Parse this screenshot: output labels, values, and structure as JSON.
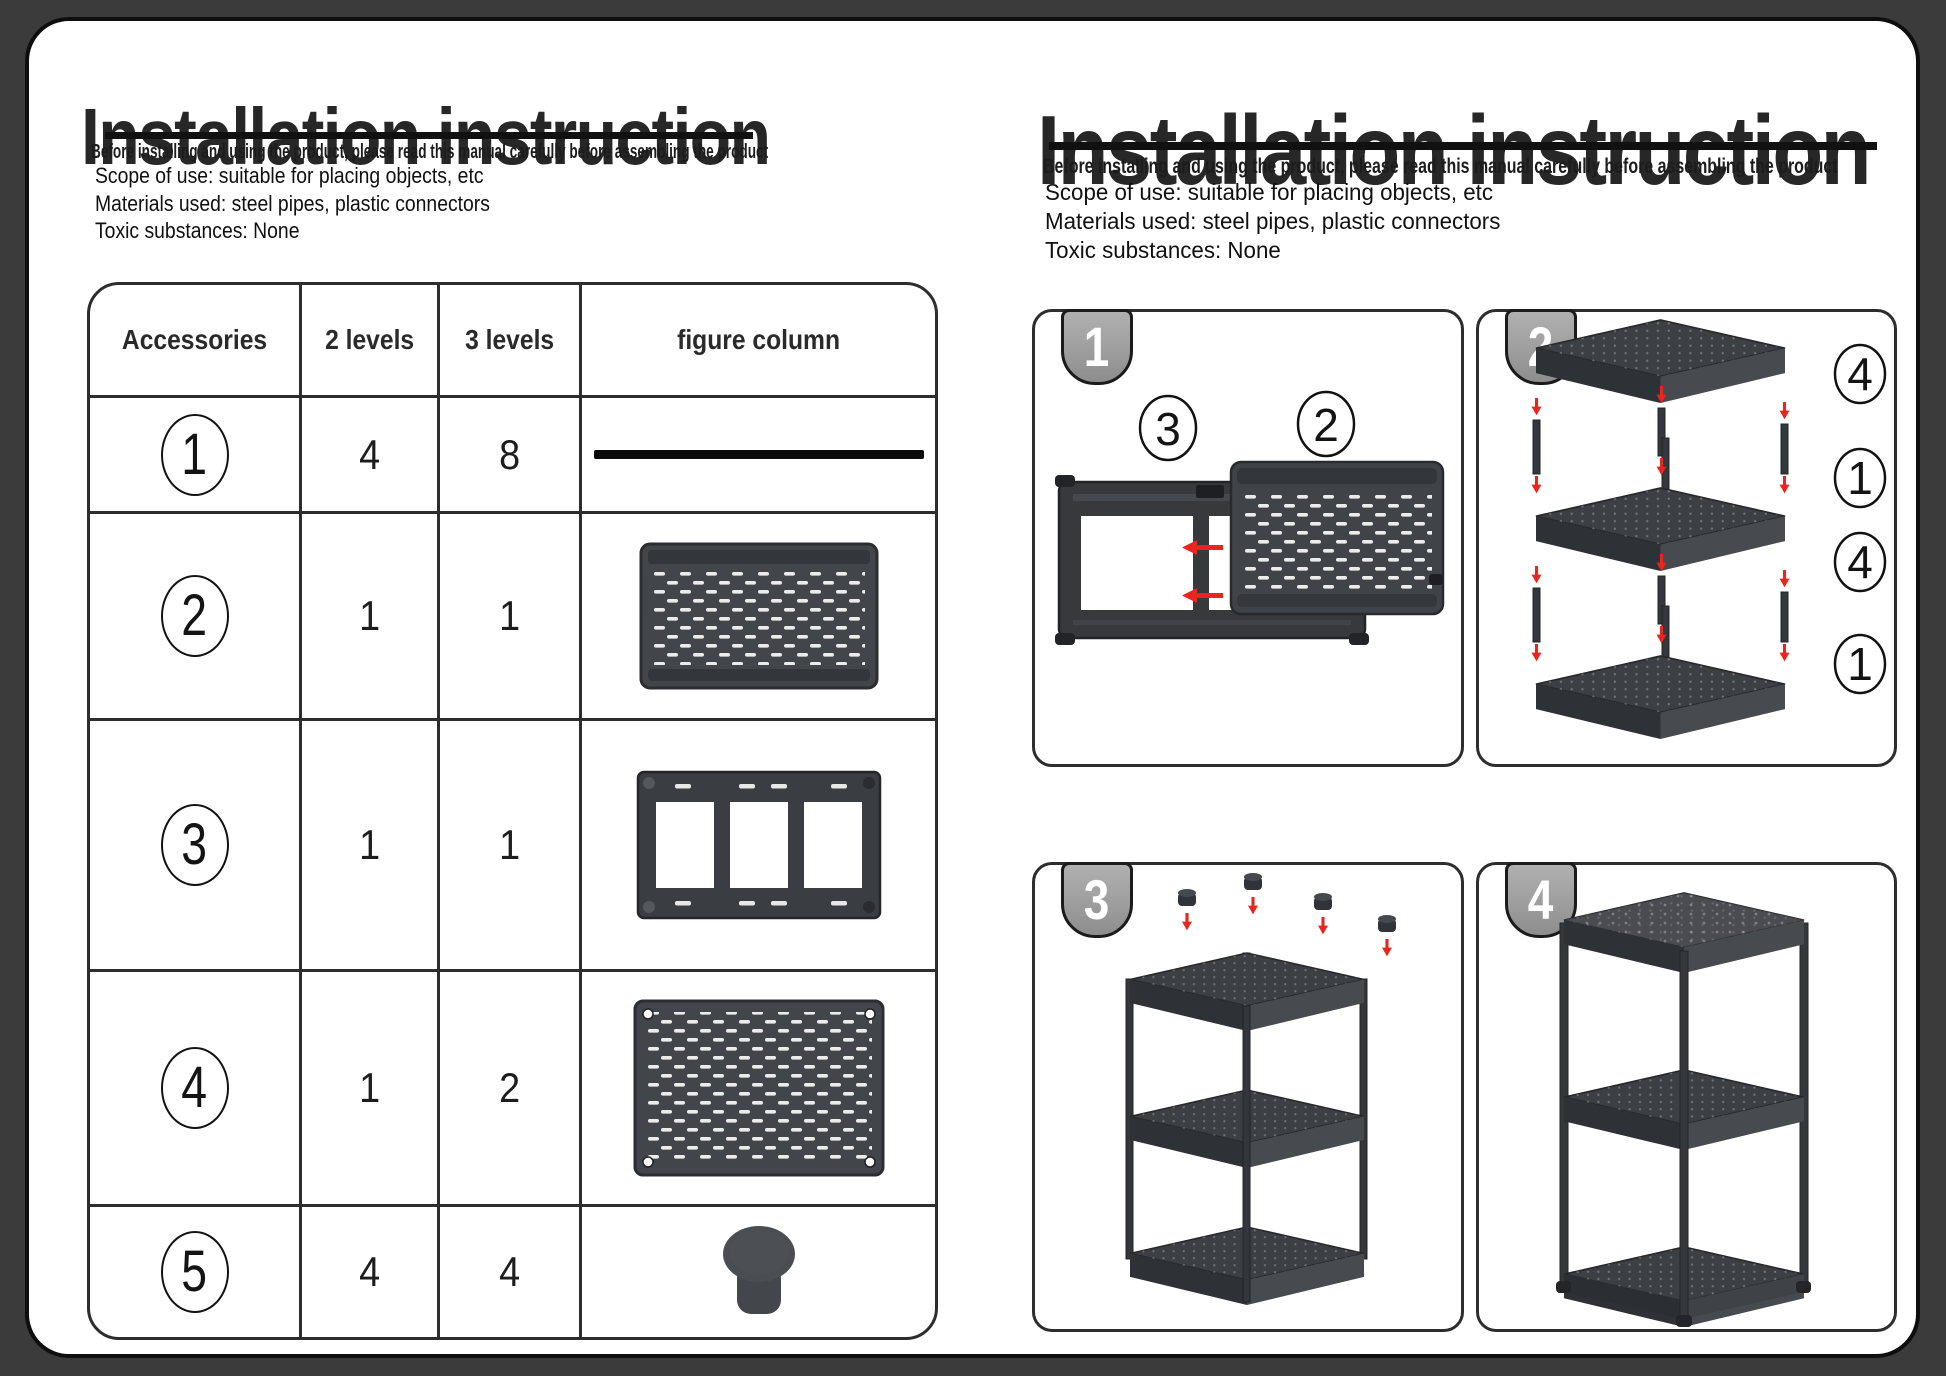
{
  "header": {
    "title": "Installation instruction",
    "subtitle": "Before installing and using the product, please read this manual carefully before assembling the product",
    "info_lines": [
      "Scope of use: suitable for placing objects, etc",
      "Materials used: steel pipes, plastic connectors",
      "Toxic substances: None"
    ]
  },
  "parts_table": {
    "headers": {
      "accessories": "Accessories",
      "levels2": "2 levels",
      "levels3": "3 levels",
      "figure": "figure column"
    },
    "rows": [
      {
        "id": "1",
        "qty_2_levels": "4",
        "qty_3_levels": "8",
        "figure": "steel-pipe"
      },
      {
        "id": "2",
        "qty_2_levels": "1",
        "qty_3_levels": "1",
        "figure": "mesh-shelf-tray"
      },
      {
        "id": "3",
        "qty_2_levels": "1",
        "qty_3_levels": "1",
        "figure": "support-frame"
      },
      {
        "id": "4",
        "qty_2_levels": "1",
        "qty_3_levels": "2",
        "figure": "perforated-panel"
      },
      {
        "id": "5",
        "qty_2_levels": "4",
        "qty_3_levels": "4",
        "figure": "foot-cap"
      }
    ]
  },
  "steps": [
    {
      "number": "1",
      "part_labels": [
        "3",
        "2"
      ]
    },
    {
      "number": "2",
      "part_labels": [
        "4",
        "1",
        "4",
        "1"
      ]
    },
    {
      "number": "3",
      "part_labels": []
    },
    {
      "number": "4",
      "part_labels": []
    }
  ],
  "colors": {
    "background": "#3b3b3b",
    "page": "#ffffff",
    "part_dark": "#3f4247",
    "arrow_red": "#e8251f",
    "tab_gray": "#9e9e9e",
    "border_dark": "#2d2d2d"
  }
}
